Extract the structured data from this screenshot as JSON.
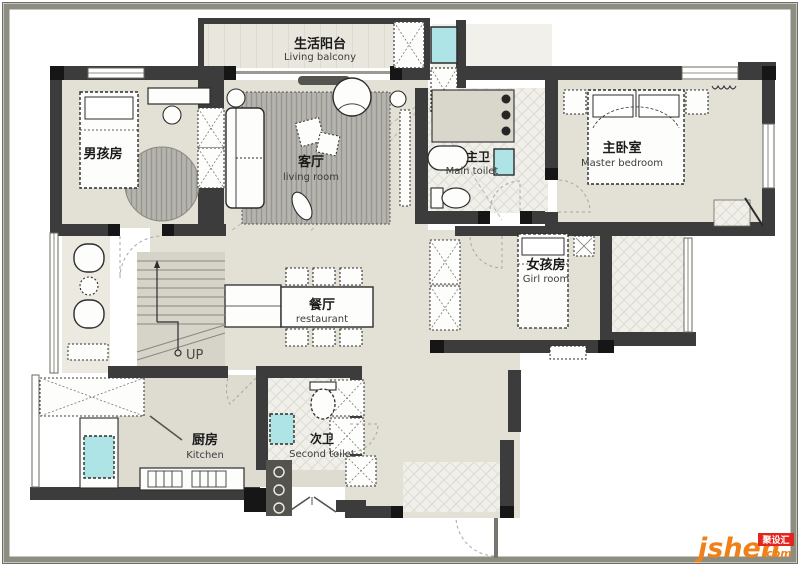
{
  "document": {
    "kind": "residential floor plan",
    "stairs_label": "UP"
  },
  "colors": {
    "frame": "#8d8d82",
    "frame_edge": "#6e6e64",
    "floor_beige": "#e3e0d6",
    "floor_kitchen": "#dedbd1",
    "floor_tile": "#efeee8",
    "wall_dark": "#3c3c3c",
    "wall_black": "#161616",
    "rug_gray": "#b4b2ac",
    "sink_cyan": "#aee4e6",
    "logo_orange": "#f08119",
    "logo_red": "#e4251f"
  },
  "rooms": [
    {
      "id": "living_balcony",
      "zh": "生活阳台",
      "en": "Living balcony"
    },
    {
      "id": "boy_room",
      "zh": "男孩房",
      "en": ""
    },
    {
      "id": "living_room",
      "zh": "客厅",
      "en": "living room"
    },
    {
      "id": "main_toilet",
      "zh": "主卫",
      "en": "Main toilet"
    },
    {
      "id": "master_bedroom",
      "zh": "主卧室",
      "en": "Master bedroom"
    },
    {
      "id": "girl_room",
      "zh": "女孩房",
      "en": "Girl room"
    },
    {
      "id": "dining_room",
      "zh": "餐厅",
      "en": "restaurant"
    },
    {
      "id": "kitchen",
      "zh": "厨房",
      "en": "Kitchen"
    },
    {
      "id": "second_toilet",
      "zh": "次卫",
      "en": "Second toilet"
    }
  ],
  "logo": {
    "brand": "jsheh",
    "tld": ".com",
    "badge": "聚设汇"
  }
}
